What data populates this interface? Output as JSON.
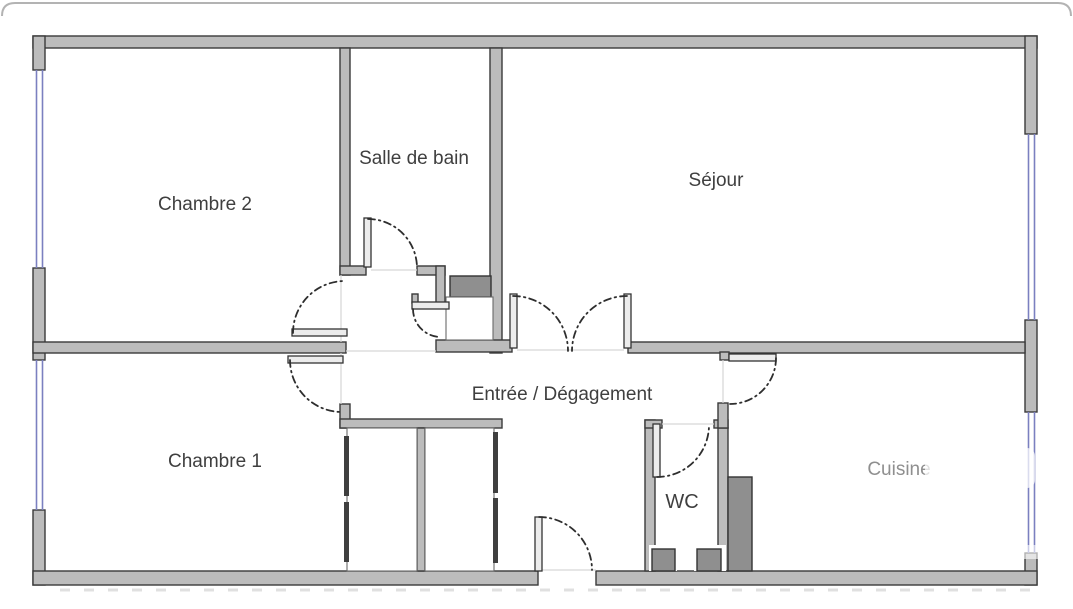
{
  "page": {
    "background": "#ffffff",
    "top_border_color": "#b3b3b3"
  },
  "floorplan": {
    "rooms": [
      {
        "name": "chambre-2",
        "label": "Chambre 2"
      },
      {
        "name": "salle-de-bain",
        "label": "Salle de bain"
      },
      {
        "name": "sejour",
        "label": "Séjour"
      },
      {
        "name": "entree-degagement",
        "label": "Entrée / Dégagement"
      },
      {
        "name": "chambre-1",
        "label": "Chambre 1"
      },
      {
        "name": "wc",
        "label": "WC"
      },
      {
        "name": "cuisine",
        "label": "Cuisine"
      }
    ],
    "colors": {
      "wall_fill": "#bcbcbc",
      "wall_outline": "#3a3a3a",
      "duct_fill": "#8f8f8f",
      "window": "#7b80c0",
      "door_arc": "#2e2e2e",
      "threshold": "#d6d6d6",
      "label_text": "#3f3f3f",
      "label_text_faded": "#8f8f8f"
    }
  }
}
